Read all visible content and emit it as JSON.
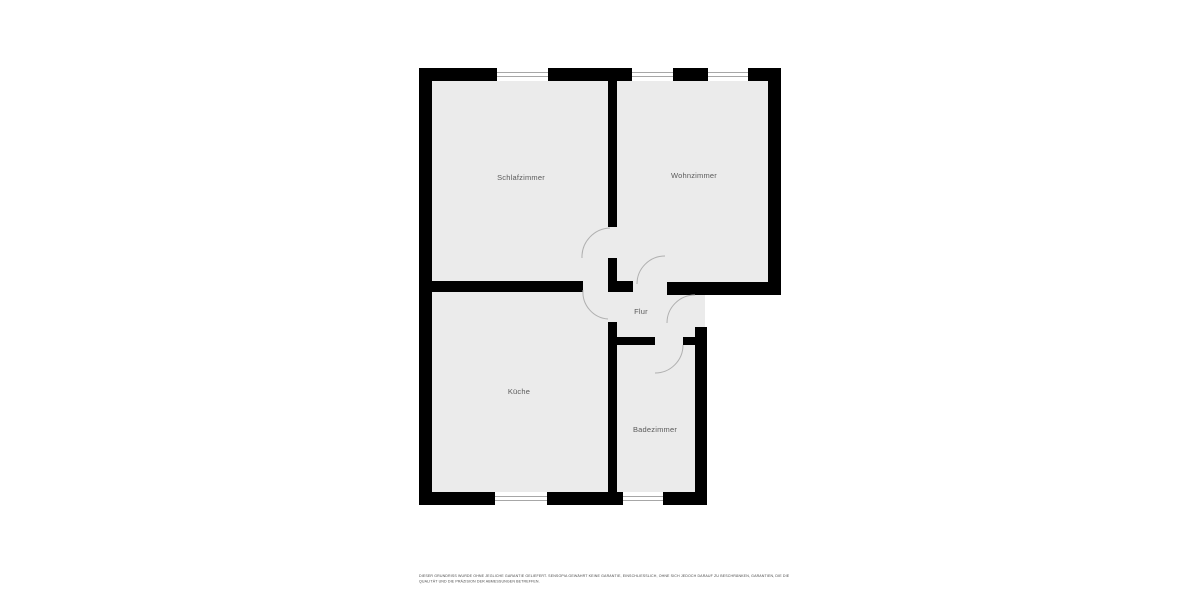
{
  "floorplan": {
    "rooms": [
      {
        "id": "schlafzimmer",
        "label": "Schlafzimmer"
      },
      {
        "id": "wohnzimmer",
        "label": "Wohnzimmer"
      },
      {
        "id": "flur",
        "label": "Flur"
      },
      {
        "id": "kueche",
        "label": "Küche"
      },
      {
        "id": "badezimmer",
        "label": "Badezimmer"
      }
    ],
    "disclaimer": {
      "line1": "DIESER GRUNDRISS WURDE OHNE JEGLICHE GARANTIE GELIEFERT. SENSOPIA GEWÄHRT KEINE GARANTIE, EINSCHLIESSLICH, OHNE SICH JEDOCH DARAUF ZU BESCHRÄNKEN, GARANTIEN, DIE DIE",
      "line2": "QUALITÄT UND DIE PRÄZISION DER ABMESSUNGEN BETREFFEN."
    },
    "colors": {
      "background": "#ffffff",
      "floor": "#ebebeb",
      "wall": "#000000",
      "label_text": "#5a5a5a",
      "door_arc": "#b0b0b0",
      "window_fill": "#ffffff",
      "window_line": "#8a8a8a",
      "disclaimer_text": "#4a4a4a"
    }
  }
}
